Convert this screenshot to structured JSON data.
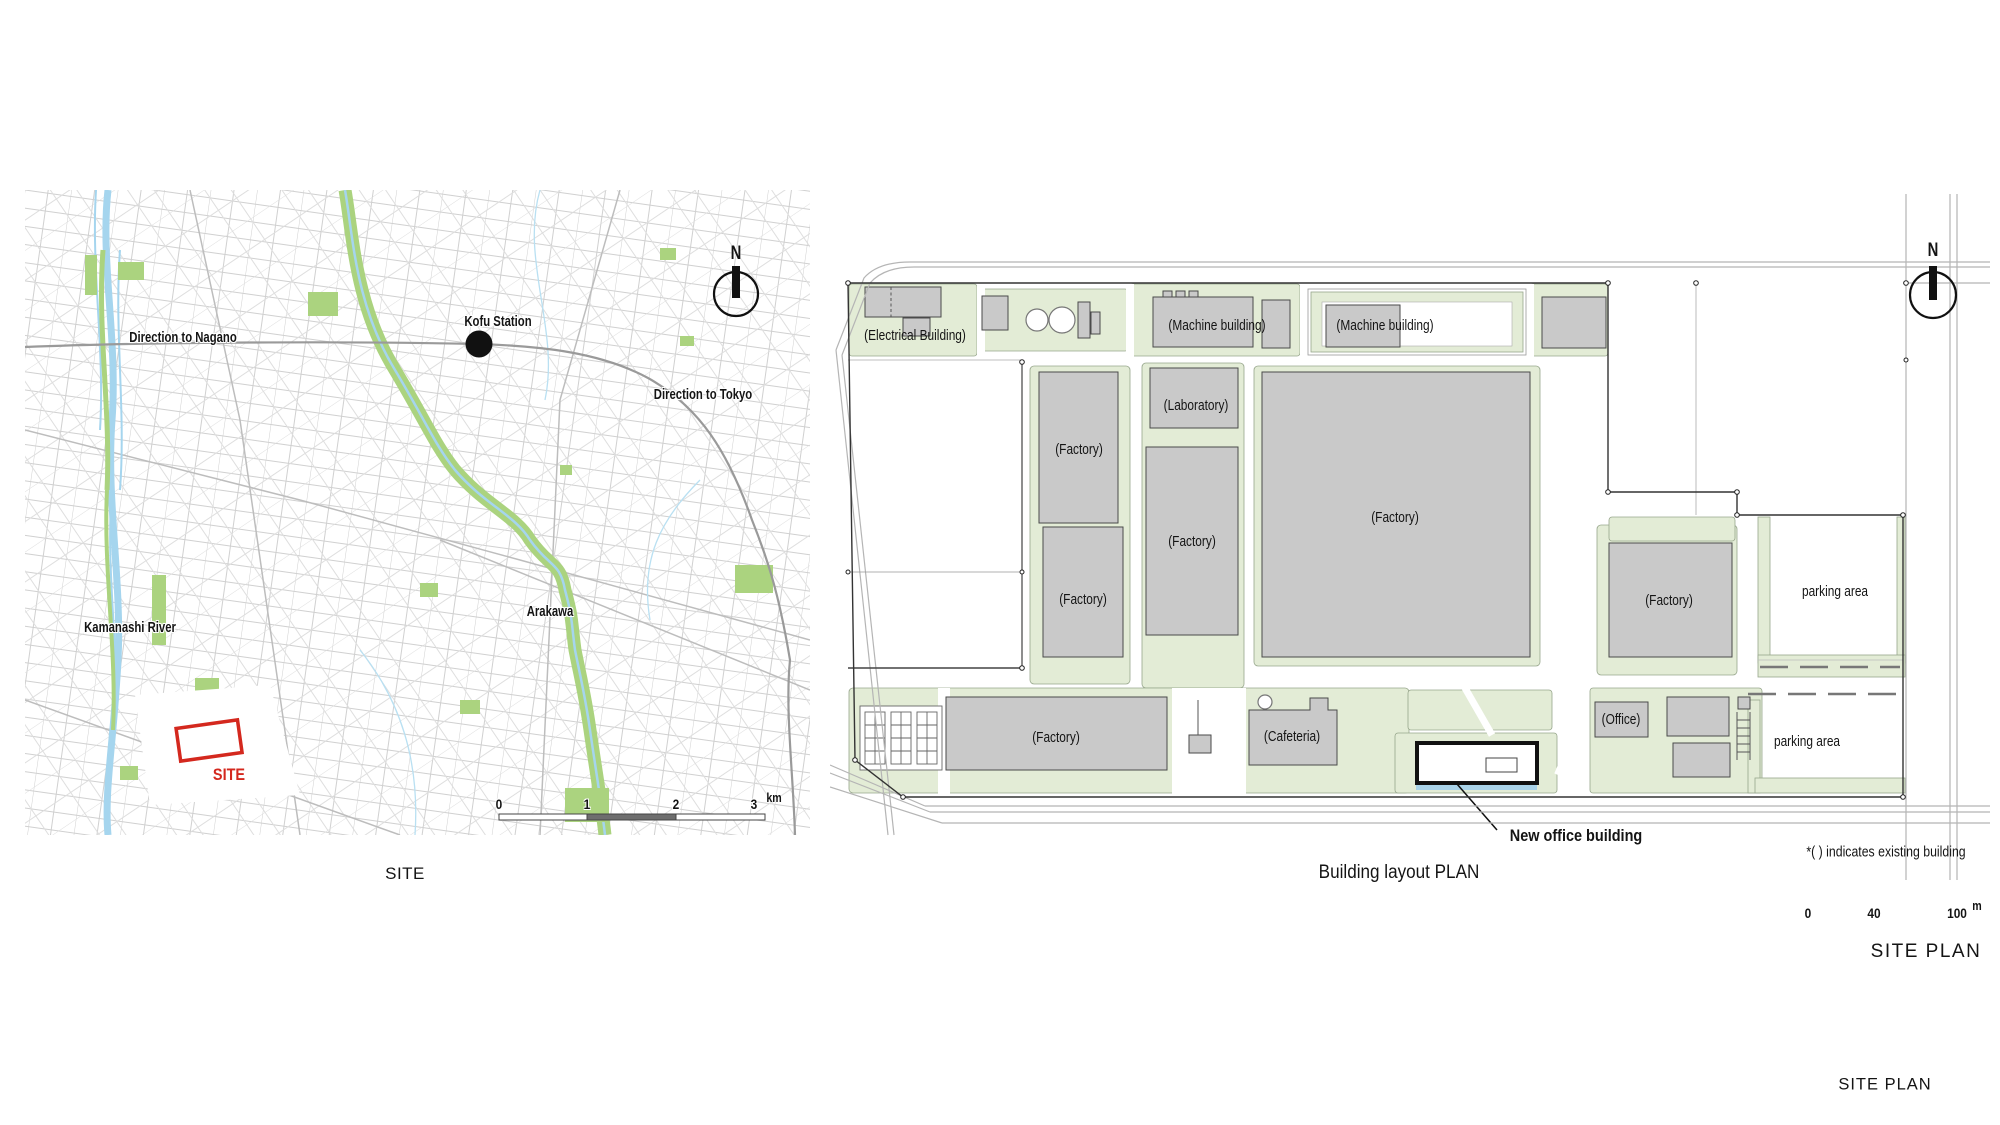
{
  "colors": {
    "site_red": "#d4281e",
    "building_gray": "#c9c9c9",
    "plan_green": "#e3ecd6",
    "map_green": "#abd37f",
    "water_blue": "#a5d5ee"
  },
  "location_map": {
    "caption": "SITE",
    "north": "N",
    "labels": {
      "direction_nagano": "Direction to Nagano",
      "kofu_station": "Kofu Station",
      "direction_tokyo": "Direction to Tokyo",
      "kamanashi_river": "Kamanashi River",
      "arakawa": "Arakawa",
      "site": "SITE"
    },
    "scale": {
      "ticks": [
        "0",
        "1",
        "2",
        "3"
      ],
      "unit": "km"
    }
  },
  "building_plan": {
    "caption": "Building layout PLAN",
    "north": "N",
    "note": "*( ) indicates existing building",
    "scale_caption": "SITE PLAN",
    "labels": {
      "electrical": "(Electrical Building)",
      "machine_1": "(Machine building)",
      "machine_2": "(Machine building)",
      "laboratory": "(Laboratory)",
      "factory_nw": "(Factory)",
      "factory_w": "(Factory)",
      "factory_mid": "(Factory)",
      "factory_main": "(Factory)",
      "factory_e": "(Factory)",
      "factory_s": "(Factory)",
      "cafeteria": "(Cafeteria)",
      "office": "(Office)",
      "parking_upper": "parking area",
      "parking_lower": "parking area",
      "new_office": "New office building"
    },
    "scale": {
      "ticks": [
        "0",
        "40",
        "100"
      ],
      "unit": "m"
    }
  },
  "page": {
    "corner_caption": "SITE PLAN"
  }
}
